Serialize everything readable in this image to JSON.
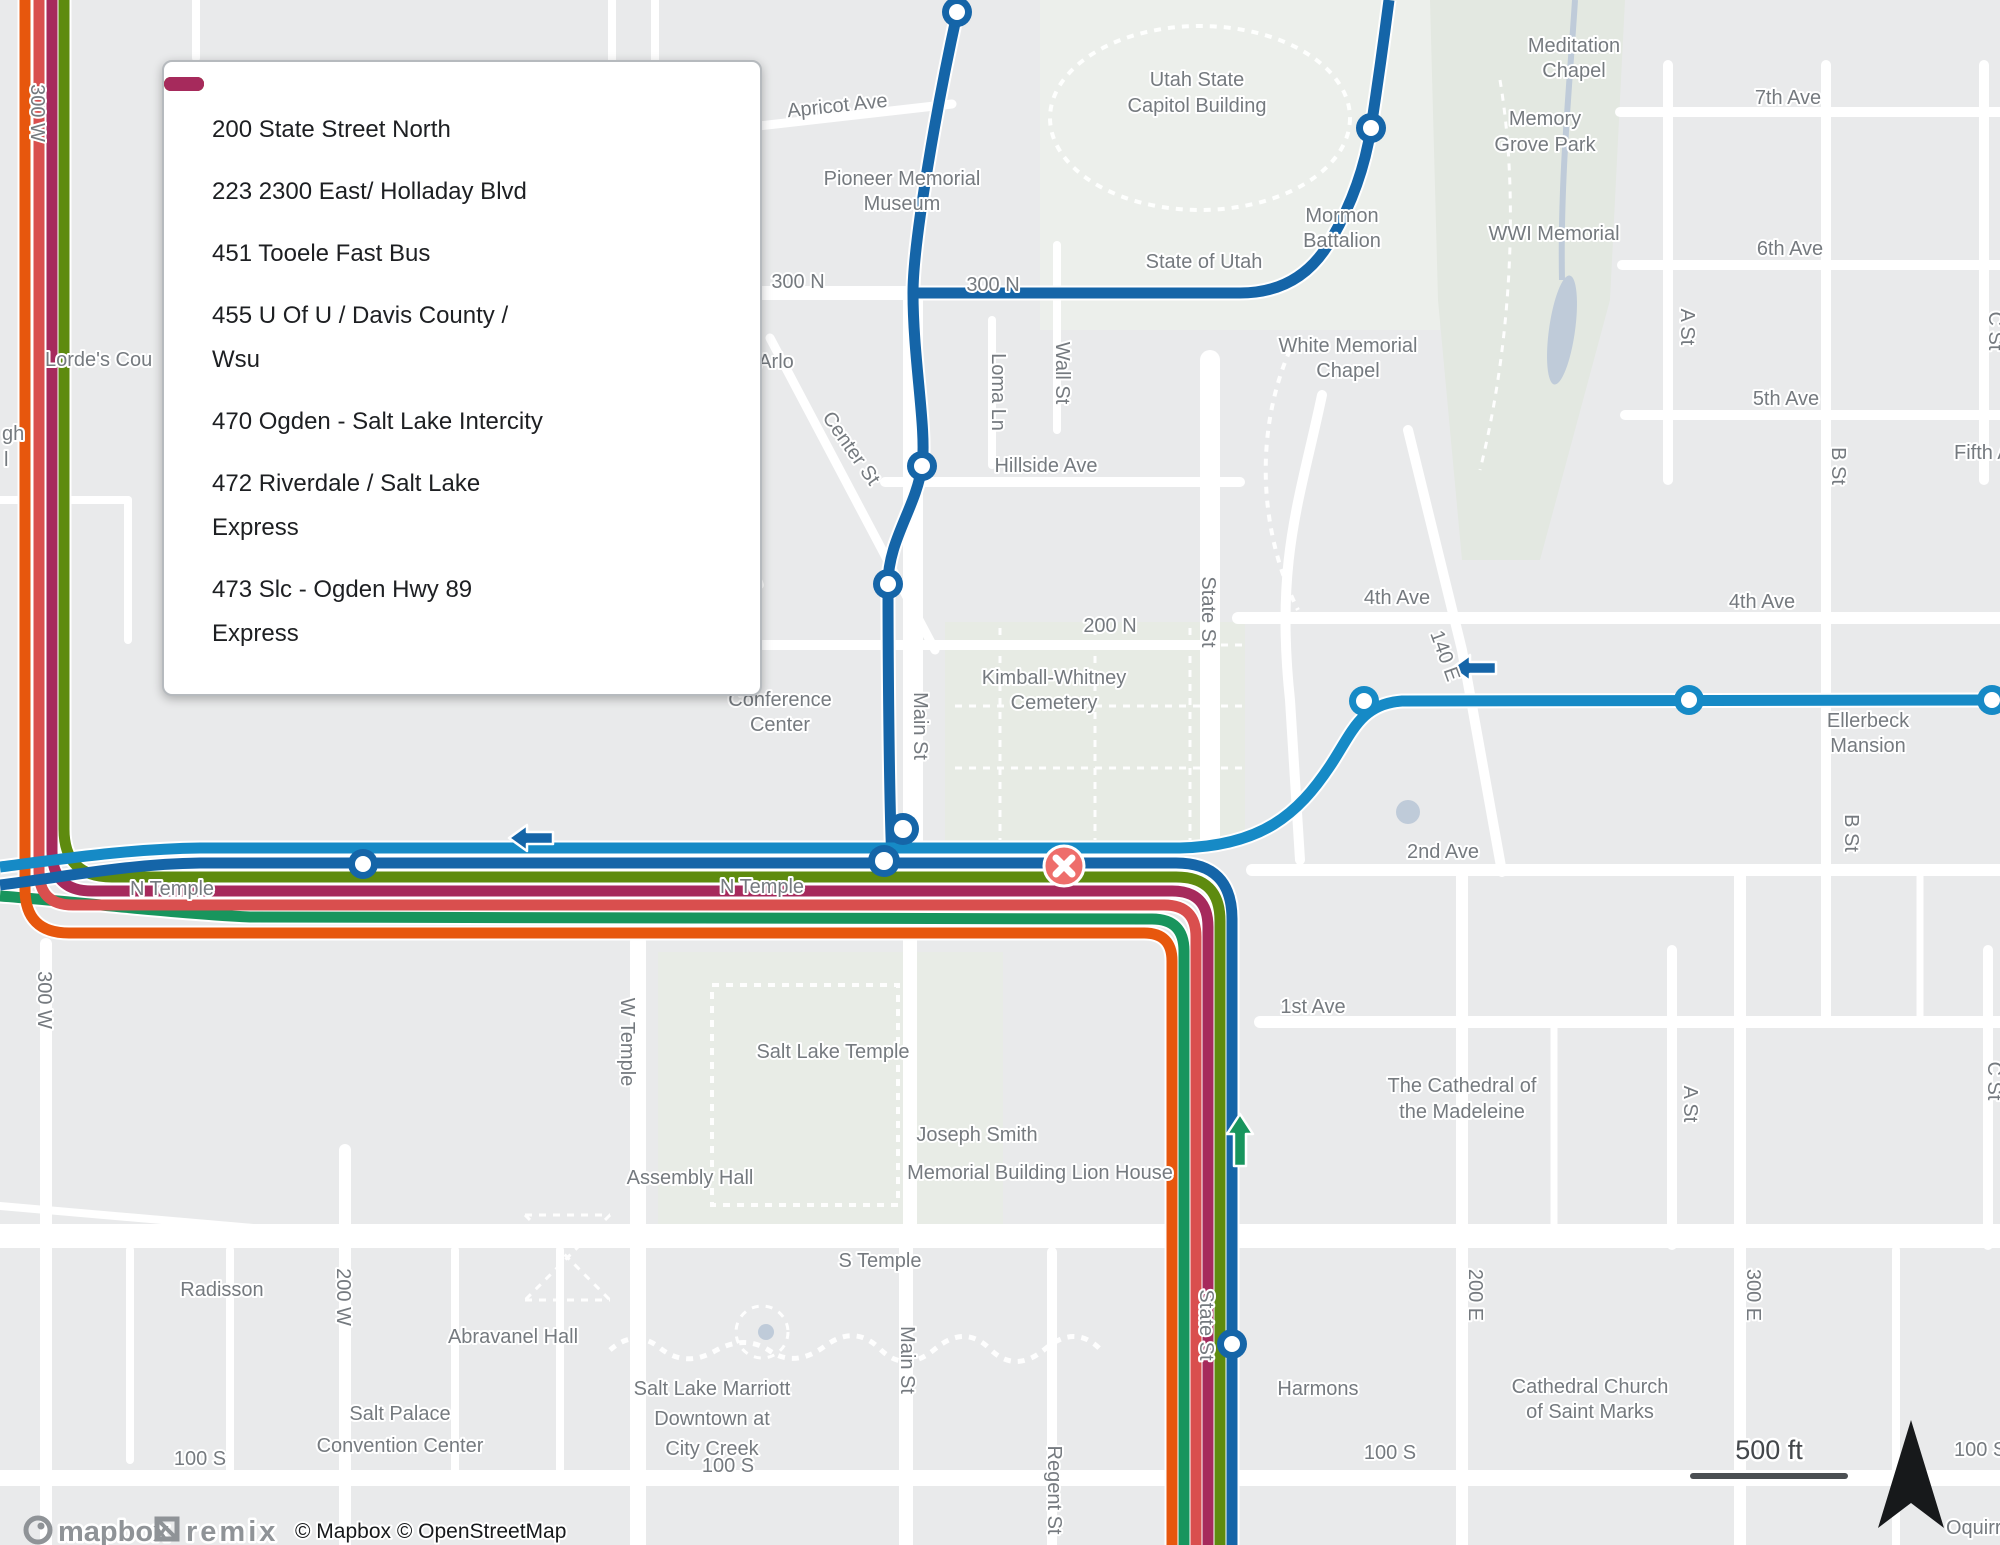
{
  "map": {
    "scale_text": "500 ft",
    "attribution": "© Mapbox © OpenStreetMap",
    "logo_mapbox": "mapbox",
    "logo_remix": "remix",
    "colors": {
      "background": "#e9eaeb",
      "road": "#ffffff",
      "label": "#757a7f",
      "park": "#e3e8e1",
      "water": "#bfcbd9",
      "closed_stop_marker": "#ee6e6b",
      "compass": "#17191b"
    }
  },
  "legend": {
    "items": [
      {
        "line1": "200 State Street North",
        "line2": "",
        "color": "#1565a8"
      },
      {
        "line1": "223 2300 East/ Holladay Blvd",
        "line2": "",
        "color": "#168ac6"
      },
      {
        "line1": "451 Tooele Fast Bus",
        "line2": "",
        "color": "#18955d"
      },
      {
        "line1": "455 U Of U / Davis County /",
        "line2": "Wsu",
        "color": "#5e8b0f"
      },
      {
        "line1": "470 Ogden - Salt Lake Intercity",
        "line2": "",
        "color": "#e7570d"
      },
      {
        "line1": "472 Riverdale / Salt Lake",
        "line2": "Express",
        "color": "#d94f4e"
      },
      {
        "line1": "473 Slc - Ogden Hwy 89",
        "line2": "Express",
        "color": "#a62a5c"
      }
    ]
  },
  "routes": [
    {
      "id": "200",
      "name": "200 State Street North",
      "color": "#1565a8"
    },
    {
      "id": "223",
      "name": "223 2300 East/ Holladay Blvd",
      "color": "#168ac6"
    },
    {
      "id": "451",
      "name": "451 Tooele Fast Bus",
      "color": "#18955d"
    },
    {
      "id": "455",
      "name": "455 U Of U / Davis County / Wsu",
      "color": "#5e8b0f"
    },
    {
      "id": "470",
      "name": "470 Ogden - Salt Lake Intercity",
      "color": "#e7570d"
    },
    {
      "id": "472",
      "name": "472 Riverdale / Salt Lake Express",
      "color": "#d94f4e"
    },
    {
      "id": "473",
      "name": "473 Slc - Ogden Hwy 89 Express",
      "color": "#a62a5c"
    }
  ],
  "stops": [
    {
      "ring": "#1565a8"
    },
    {
      "ring": "#1565a8"
    },
    {
      "ring": "#1565a8"
    },
    {
      "ring": "#1565a8"
    },
    {
      "ring": "#1565a8"
    },
    {
      "ring": "#1565a8"
    },
    {
      "ring": "#1565a8"
    },
    {
      "ring": "#168ac6"
    },
    {
      "ring": "#168ac6"
    },
    {
      "ring": "#168ac6"
    },
    {
      "ring": "#1565a8"
    }
  ],
  "labels": [
    {
      "text": "Apricot Ave"
    },
    {
      "text": "Pioneer Memorial"
    },
    {
      "text": "Museum"
    },
    {
      "text": "300 N"
    },
    {
      "text": "300 N"
    },
    {
      "text": "Utah State"
    },
    {
      "text": "Capitol Building"
    },
    {
      "text": "State of Utah"
    },
    {
      "text": "Mormon"
    },
    {
      "text": "Battalion"
    },
    {
      "text": "White Memorial"
    },
    {
      "text": "Chapel"
    },
    {
      "text": "Meditation"
    },
    {
      "text": "Chapel"
    },
    {
      "text": "Memory"
    },
    {
      "text": "Grove Park"
    },
    {
      "text": "WWI Memorial"
    },
    {
      "text": "7th Ave"
    },
    {
      "text": "6th Ave"
    },
    {
      "text": "5th Ave"
    },
    {
      "text": "Fifth Av"
    },
    {
      "text": "A St"
    },
    {
      "text": "B St"
    },
    {
      "text": "C St"
    },
    {
      "text": "4th Ave"
    },
    {
      "text": "4th Ave"
    },
    {
      "text": "140 E"
    },
    {
      "text": "Arlo"
    },
    {
      "text": "Lorde's Cou"
    },
    {
      "text": "gh"
    },
    {
      "text": "l"
    },
    {
      "text": "Center St"
    },
    {
      "text": "Wall St"
    },
    {
      "text": "Loma Ln"
    },
    {
      "text": "Hillside Ave"
    },
    {
      "text": "200 N"
    },
    {
      "text": "State St"
    },
    {
      "text": "Kimball-Whitney"
    },
    {
      "text": "Cemetery"
    },
    {
      "text": "Conference"
    },
    {
      "text": "Center"
    },
    {
      "text": "Main St"
    },
    {
      "text": "N Temple"
    },
    {
      "text": "N Temple"
    },
    {
      "text": "2nd Ave"
    },
    {
      "text": "Ellerbeck"
    },
    {
      "text": "Mansion"
    },
    {
      "text": "B St"
    },
    {
      "text": "C St"
    },
    {
      "text": "A St"
    },
    {
      "text": "1st Ave"
    },
    {
      "text": "300 W"
    },
    {
      "text": "300 W"
    },
    {
      "text": "W Temple"
    },
    {
      "text": "Salt Lake Temple"
    },
    {
      "text": "Assembly Hall"
    },
    {
      "text": "Joseph Smith"
    },
    {
      "text": "Memorial Building Lion House"
    },
    {
      "text": "S Temple"
    },
    {
      "text": "Radisson"
    },
    {
      "text": "200 W"
    },
    {
      "text": "Abravanel Hall"
    },
    {
      "text": "Main St"
    },
    {
      "text": "Salt Lake Marriott"
    },
    {
      "text": "Downtown at"
    },
    {
      "text": "City Creek"
    },
    {
      "text": "Salt Palace"
    },
    {
      "text": "Convention Center"
    },
    {
      "text": "100 S"
    },
    {
      "text": "100 S"
    },
    {
      "text": "Regent St"
    },
    {
      "text": "Harmons"
    },
    {
      "text": "100 S"
    },
    {
      "text": "Cathedral Church"
    },
    {
      "text": "of Saint Marks"
    },
    {
      "text": "200 E"
    },
    {
      "text": "300 E"
    },
    {
      "text": "The Cathedral of"
    },
    {
      "text": "the Madeleine"
    },
    {
      "text": "State St"
    },
    {
      "text": "100 S"
    },
    {
      "text": "Oquirrh"
    }
  ]
}
